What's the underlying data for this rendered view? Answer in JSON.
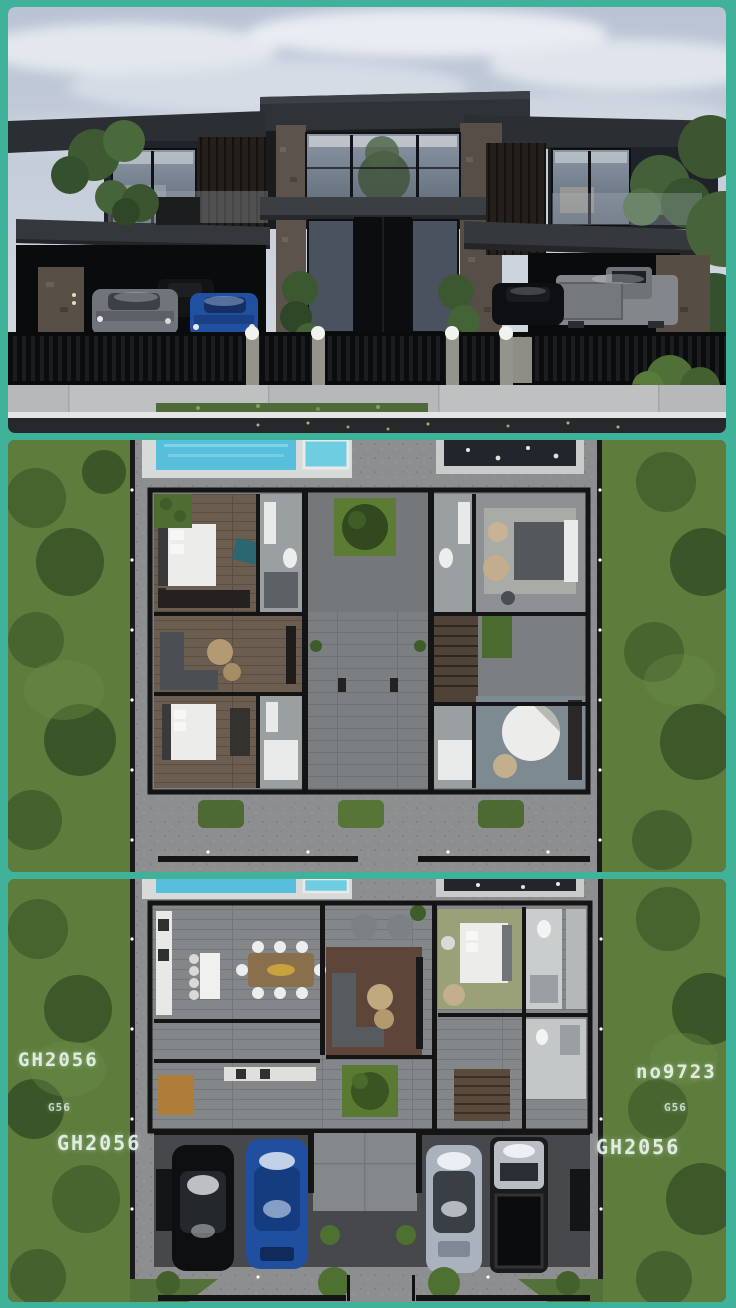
{
  "frame": {
    "border_color": "#41b29a"
  },
  "labels": [
    {
      "id": "left-top",
      "side": "left",
      "text": "GH2056"
    },
    {
      "id": "left-middle",
      "side": "left",
      "text": "G56"
    },
    {
      "id": "left-bottom",
      "side": "left",
      "text": "GH2056"
    },
    {
      "id": "right-top",
      "side": "right",
      "text": "no9723"
    },
    {
      "id": "right-middle",
      "side": "right",
      "text": "G56"
    },
    {
      "id": "right-bottom",
      "side": "right",
      "text": "GH2056"
    }
  ],
  "palette": {
    "teal_border": "#41b29a",
    "sky": "#c3cbd9",
    "facade_dark": "#1b1d1f",
    "roof_slab": "#2e3236",
    "stone_column": "#5c544c",
    "glass": "#8b96a4",
    "grass": "#5e7d3d",
    "tree_green": "#425d2d",
    "paving_grey": "#8d8e90",
    "pool_water": "#57bfdc",
    "wood_floor": "#6b5d4f",
    "plan_wall": "#141414",
    "garage_asphalt": "#47484c",
    "car_blue": "#2050a0",
    "car_black": "#0e0f12",
    "car_grey": "#70757b",
    "car_silver": "#aab3bd",
    "label_text": "#e9f6ee"
  }
}
